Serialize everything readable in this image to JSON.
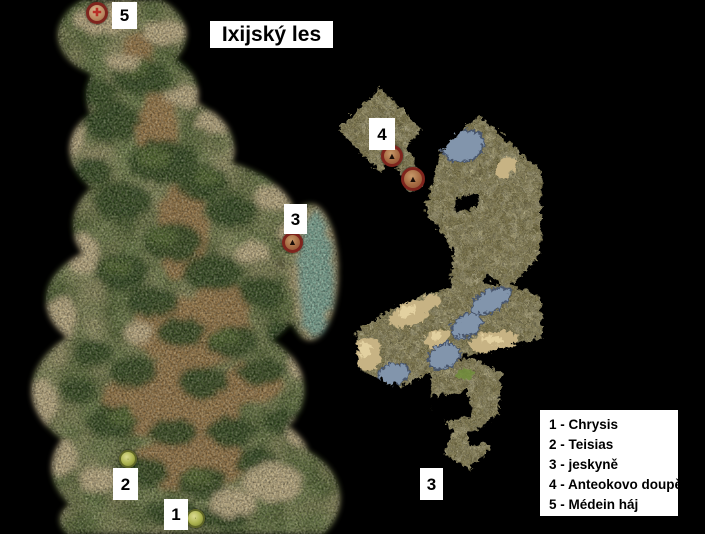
{
  "title": "Ixijský les",
  "legend": {
    "items": [
      "1 - Chrysis",
      "2 - Teisias",
      "3 - jeskyně",
      "4 - Anteokovo doupě",
      "5 - Médein háj"
    ]
  },
  "markers": {
    "forest": {
      "m1": "1",
      "m2": "2",
      "m3": "3",
      "m5": "5"
    },
    "cave": {
      "m4": "4",
      "m3_exit": "3"
    }
  },
  "icons": {
    "grove_marker": "✚",
    "cave_entrance_marker": "▲"
  },
  "colors": {
    "background": "#000000",
    "label_box": "#ffffff",
    "label_text": "#000000",
    "forest_green": "#4e5e30",
    "clearing_brown": "#9b7748",
    "rock_tan": "#c2b088",
    "lake_teal": "#7ba695",
    "cave_floor": "#7b7347",
    "pool_blue": "#8295ac",
    "marker_red_ring": "#7e241d",
    "marker_olive": "#9aa342"
  }
}
